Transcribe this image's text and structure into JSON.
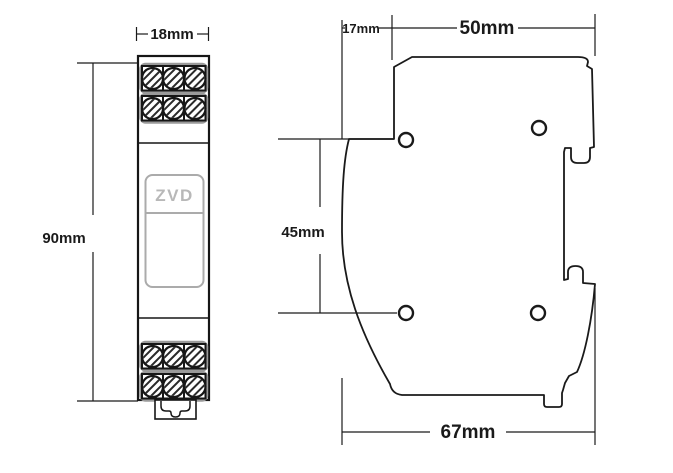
{
  "drawing": {
    "front_view": {
      "label": "ZVD",
      "width_dim": "18mm",
      "height_dim": "90mm"
    },
    "side_view": {
      "top_depth_dim": "17mm",
      "body_width_dim": "50mm",
      "hole_spacing_dim": "45mm",
      "overall_depth_dim": "67mm"
    },
    "colors": {
      "line": "#1a1a1a",
      "accent_gray": "#9a9a9a",
      "label_text": "#b8b8b8",
      "background": "#ffffff"
    }
  }
}
